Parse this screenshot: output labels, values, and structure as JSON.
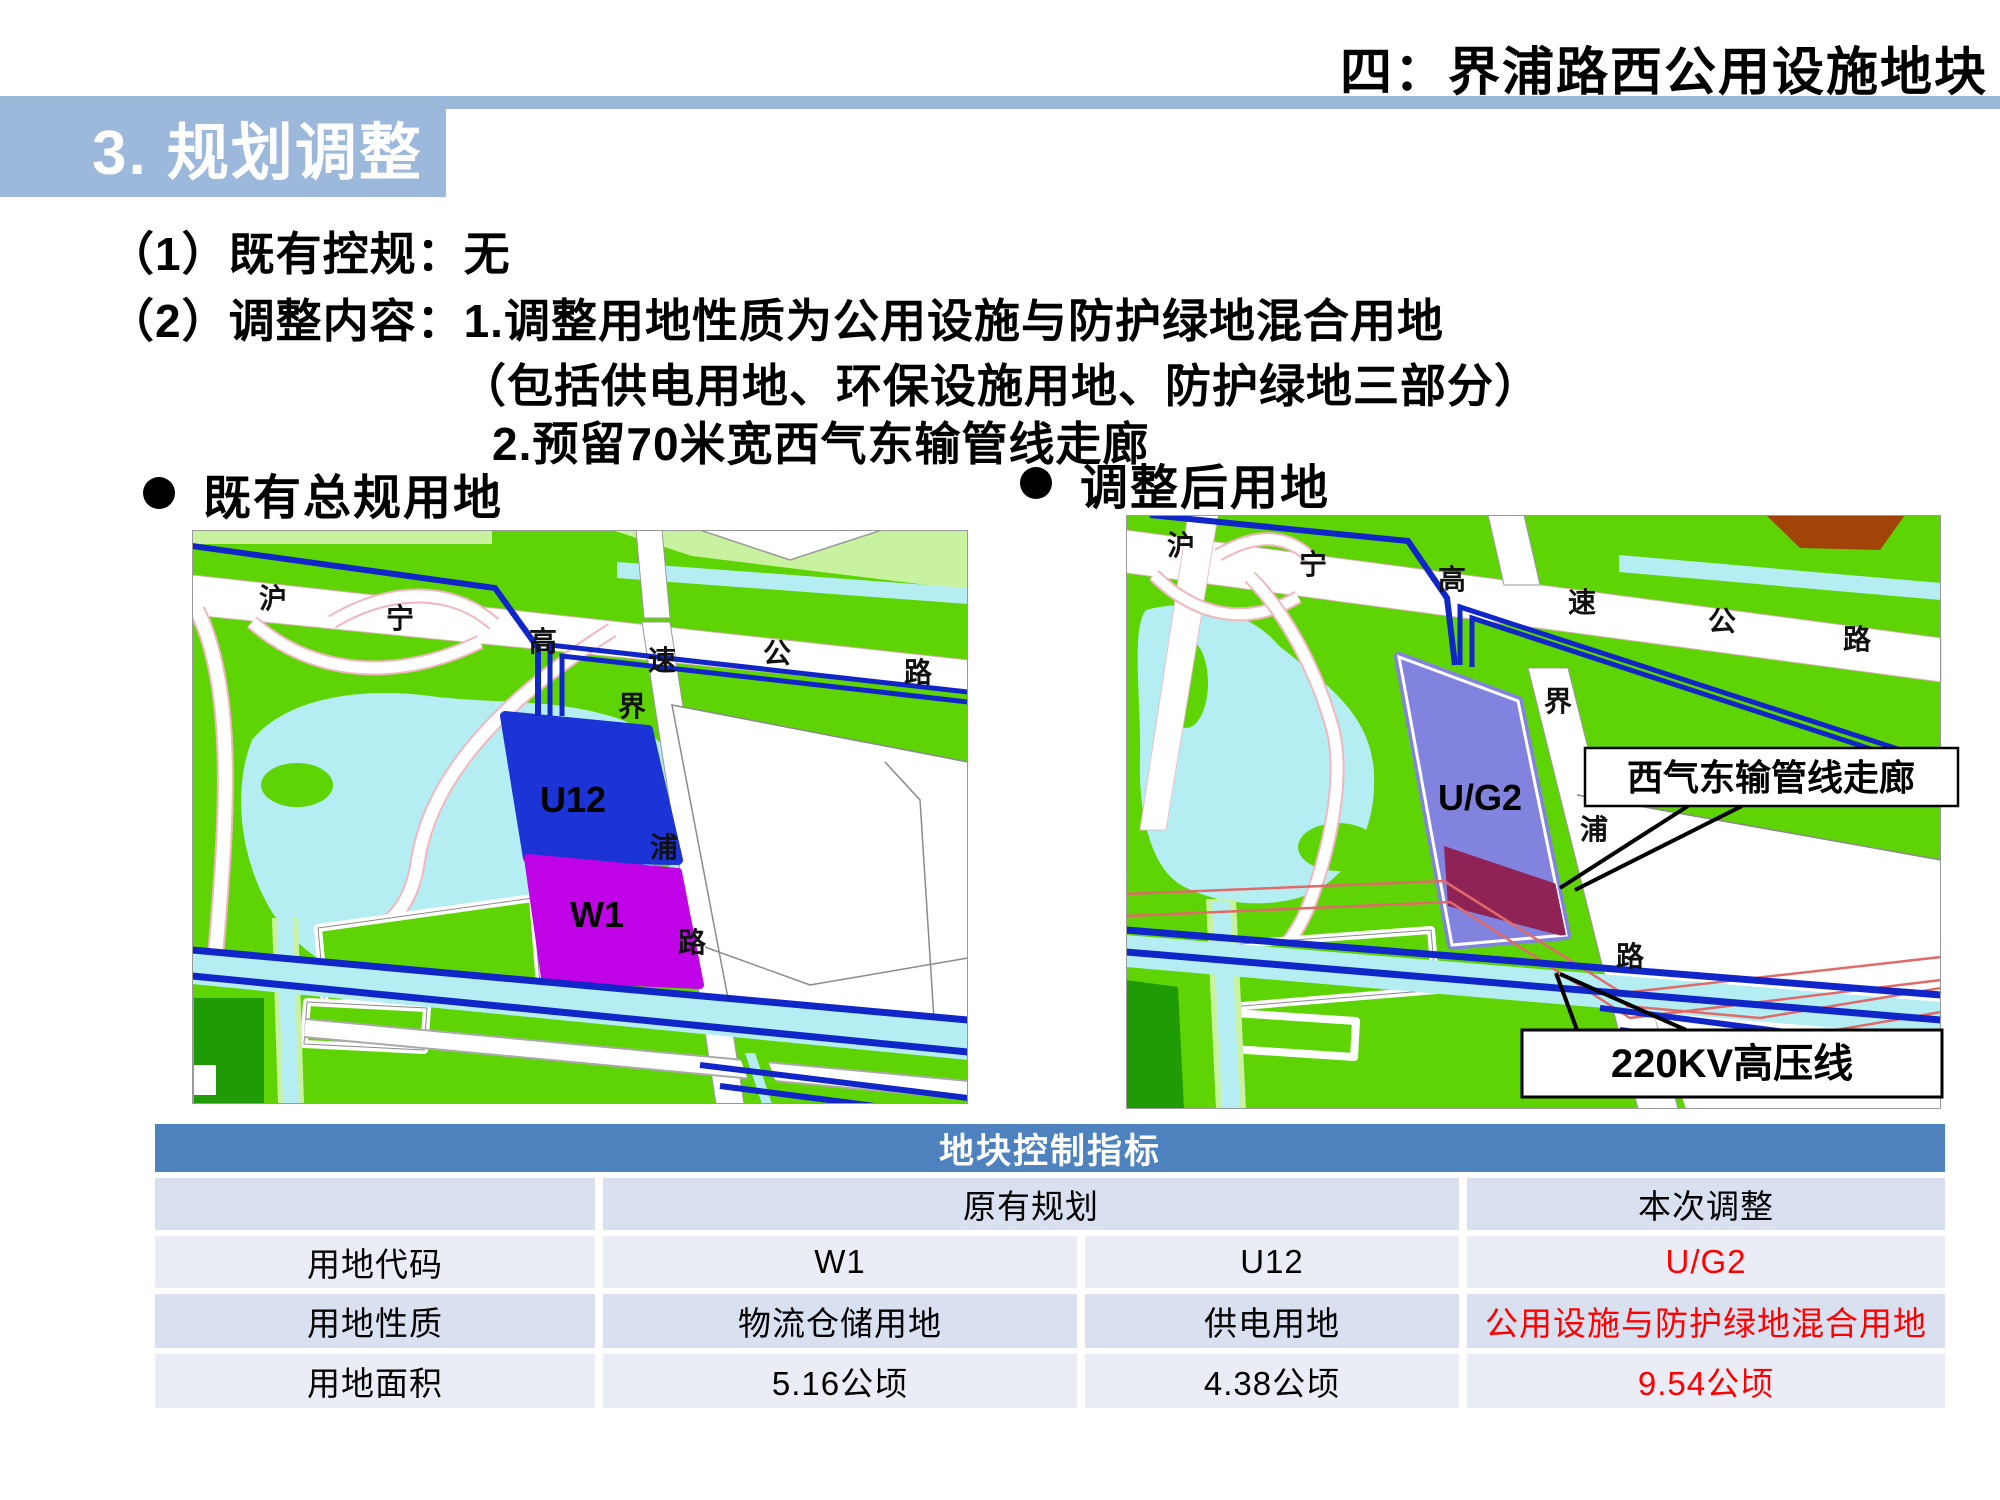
{
  "slide": {
    "corner_title": "四：界浦路西公用设施地块",
    "section_title": "3. 规划调整"
  },
  "content": {
    "line1": "（1）既有控规：无",
    "line2": "（2）调整内容：1.调整用地性质为公用设施与防护绿地混合用地",
    "line3": "（包括供电用地、环保设施用地、防护绿地三部分）",
    "line4": "2.预留70米宽西气东输管线走廊"
  },
  "bullets": {
    "left": "既有总规用地",
    "right": "调整后用地"
  },
  "maps": {
    "left": {
      "labels": [
        {
          "t": "沪",
          "x": 81,
          "y": 78,
          "k": "road"
        },
        {
          "t": "宁",
          "x": 208,
          "y": 98,
          "k": "road"
        },
        {
          "t": "高",
          "x": 351,
          "y": 121,
          "k": "road"
        },
        {
          "t": "速",
          "x": 470,
          "y": 140,
          "k": "road"
        },
        {
          "t": "公",
          "x": 585,
          "y": 133,
          "k": "road"
        },
        {
          "t": "路",
          "x": 726,
          "y": 152,
          "k": "road"
        },
        {
          "t": "界",
          "x": 440,
          "y": 186,
          "k": "road"
        },
        {
          "t": "浦",
          "x": 472,
          "y": 327,
          "k": "road"
        },
        {
          "t": "路",
          "x": 500,
          "y": 422,
          "k": "road"
        },
        {
          "t": "U12",
          "x": 381,
          "y": 282,
          "k": "parcel"
        },
        {
          "t": "W1",
          "x": 405,
          "y": 397,
          "k": "parcel"
        }
      ]
    },
    "right": {
      "labels": [
        {
          "t": "沪",
          "x": 55,
          "y": 40,
          "k": "road"
        },
        {
          "t": "宁",
          "x": 187,
          "y": 59,
          "k": "road"
        },
        {
          "t": "高",
          "x": 326,
          "y": 74,
          "k": "road"
        },
        {
          "t": "速",
          "x": 456,
          "y": 97,
          "k": "road"
        },
        {
          "t": "公",
          "x": 596,
          "y": 116,
          "k": "road"
        },
        {
          "t": "路",
          "x": 731,
          "y": 134,
          "k": "road"
        },
        {
          "t": "界",
          "x": 432,
          "y": 196,
          "k": "road"
        },
        {
          "t": "浦",
          "x": 468,
          "y": 324,
          "k": "road"
        },
        {
          "t": "路",
          "x": 504,
          "y": 451,
          "k": "road"
        },
        {
          "t": "U/G2",
          "x": 354,
          "y": 295,
          "k": "parcel"
        }
      ]
    }
  },
  "callouts": {
    "pipeline": "西气东输管线走廊",
    "powerline": "220KV高压线"
  },
  "table": {
    "title": "地块控制指标",
    "group_left": "原有规划",
    "group_right": "本次调整",
    "rows": [
      {
        "label": "用地代码",
        "w1": "W1",
        "u12": "U12",
        "adjusted": "U/G2"
      },
      {
        "label": "用地性质",
        "w1": "物流仓储用地",
        "u12": "供电用地",
        "adjusted": "公用设施与防护绿地混合用地"
      },
      {
        "label": "用地面积",
        "w1": "5.16公顷",
        "u12": "4.38公顷",
        "adjusted": "9.54公顷"
      }
    ]
  },
  "colors": {
    "accent_band": "#9cb8da",
    "table_header": "#4d82be",
    "row_dark": "#d9e1f0",
    "row_light": "#eaedf6",
    "highlight_red": "#ff0000",
    "map_green": "#5fd405",
    "map_pale_green": "#c9f2a0",
    "map_dark_green": "#1f9c05",
    "map_water": "#b4eef2",
    "parcel_u12_blue": "#1c33d6",
    "parcel_w1_magenta": "#c003e6",
    "parcel_ug2_purple": "#8283de",
    "corridor_maroon": "#8f2355",
    "corridor_redline": "#e06a6a",
    "powerline_blue": "#1026c9"
  }
}
